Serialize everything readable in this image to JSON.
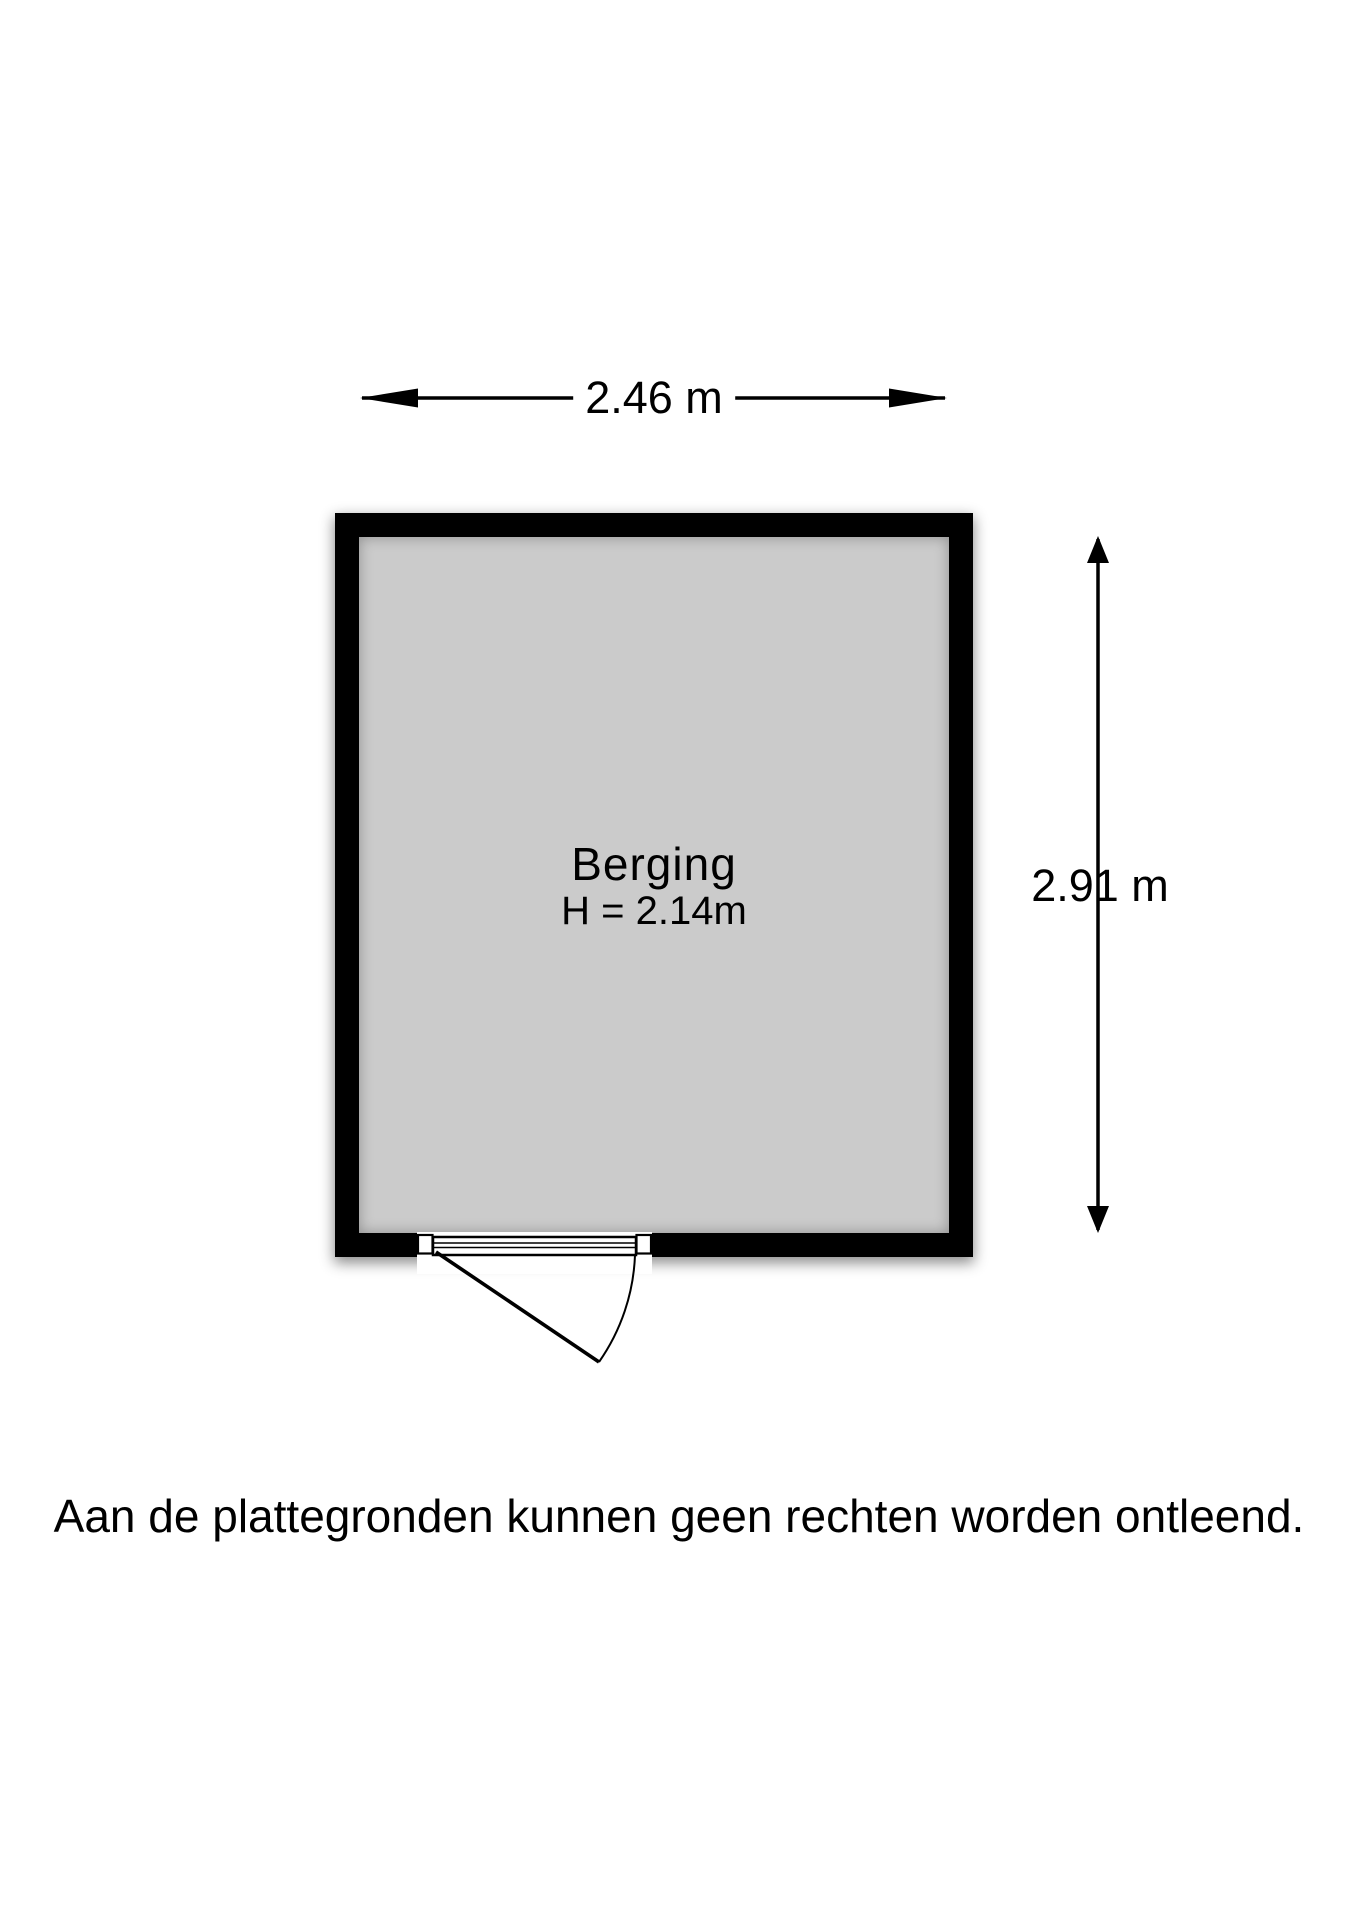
{
  "floorplan": {
    "room": {
      "name": "Berging",
      "ceiling_height_label": "H = 2.14m"
    },
    "dimensions": {
      "width_label": "2.46 m",
      "height_label": "2.91 m"
    },
    "door": {
      "type": "hinged-door-swing",
      "wall": "bottom",
      "hinge_side": "left"
    },
    "colors": {
      "wall": "#000000",
      "floor": "#cbcbcb",
      "line": "#000000",
      "background": "#ffffff"
    }
  },
  "disclaimer": "Aan de plattegronden kunnen geen rechten worden ontleend."
}
